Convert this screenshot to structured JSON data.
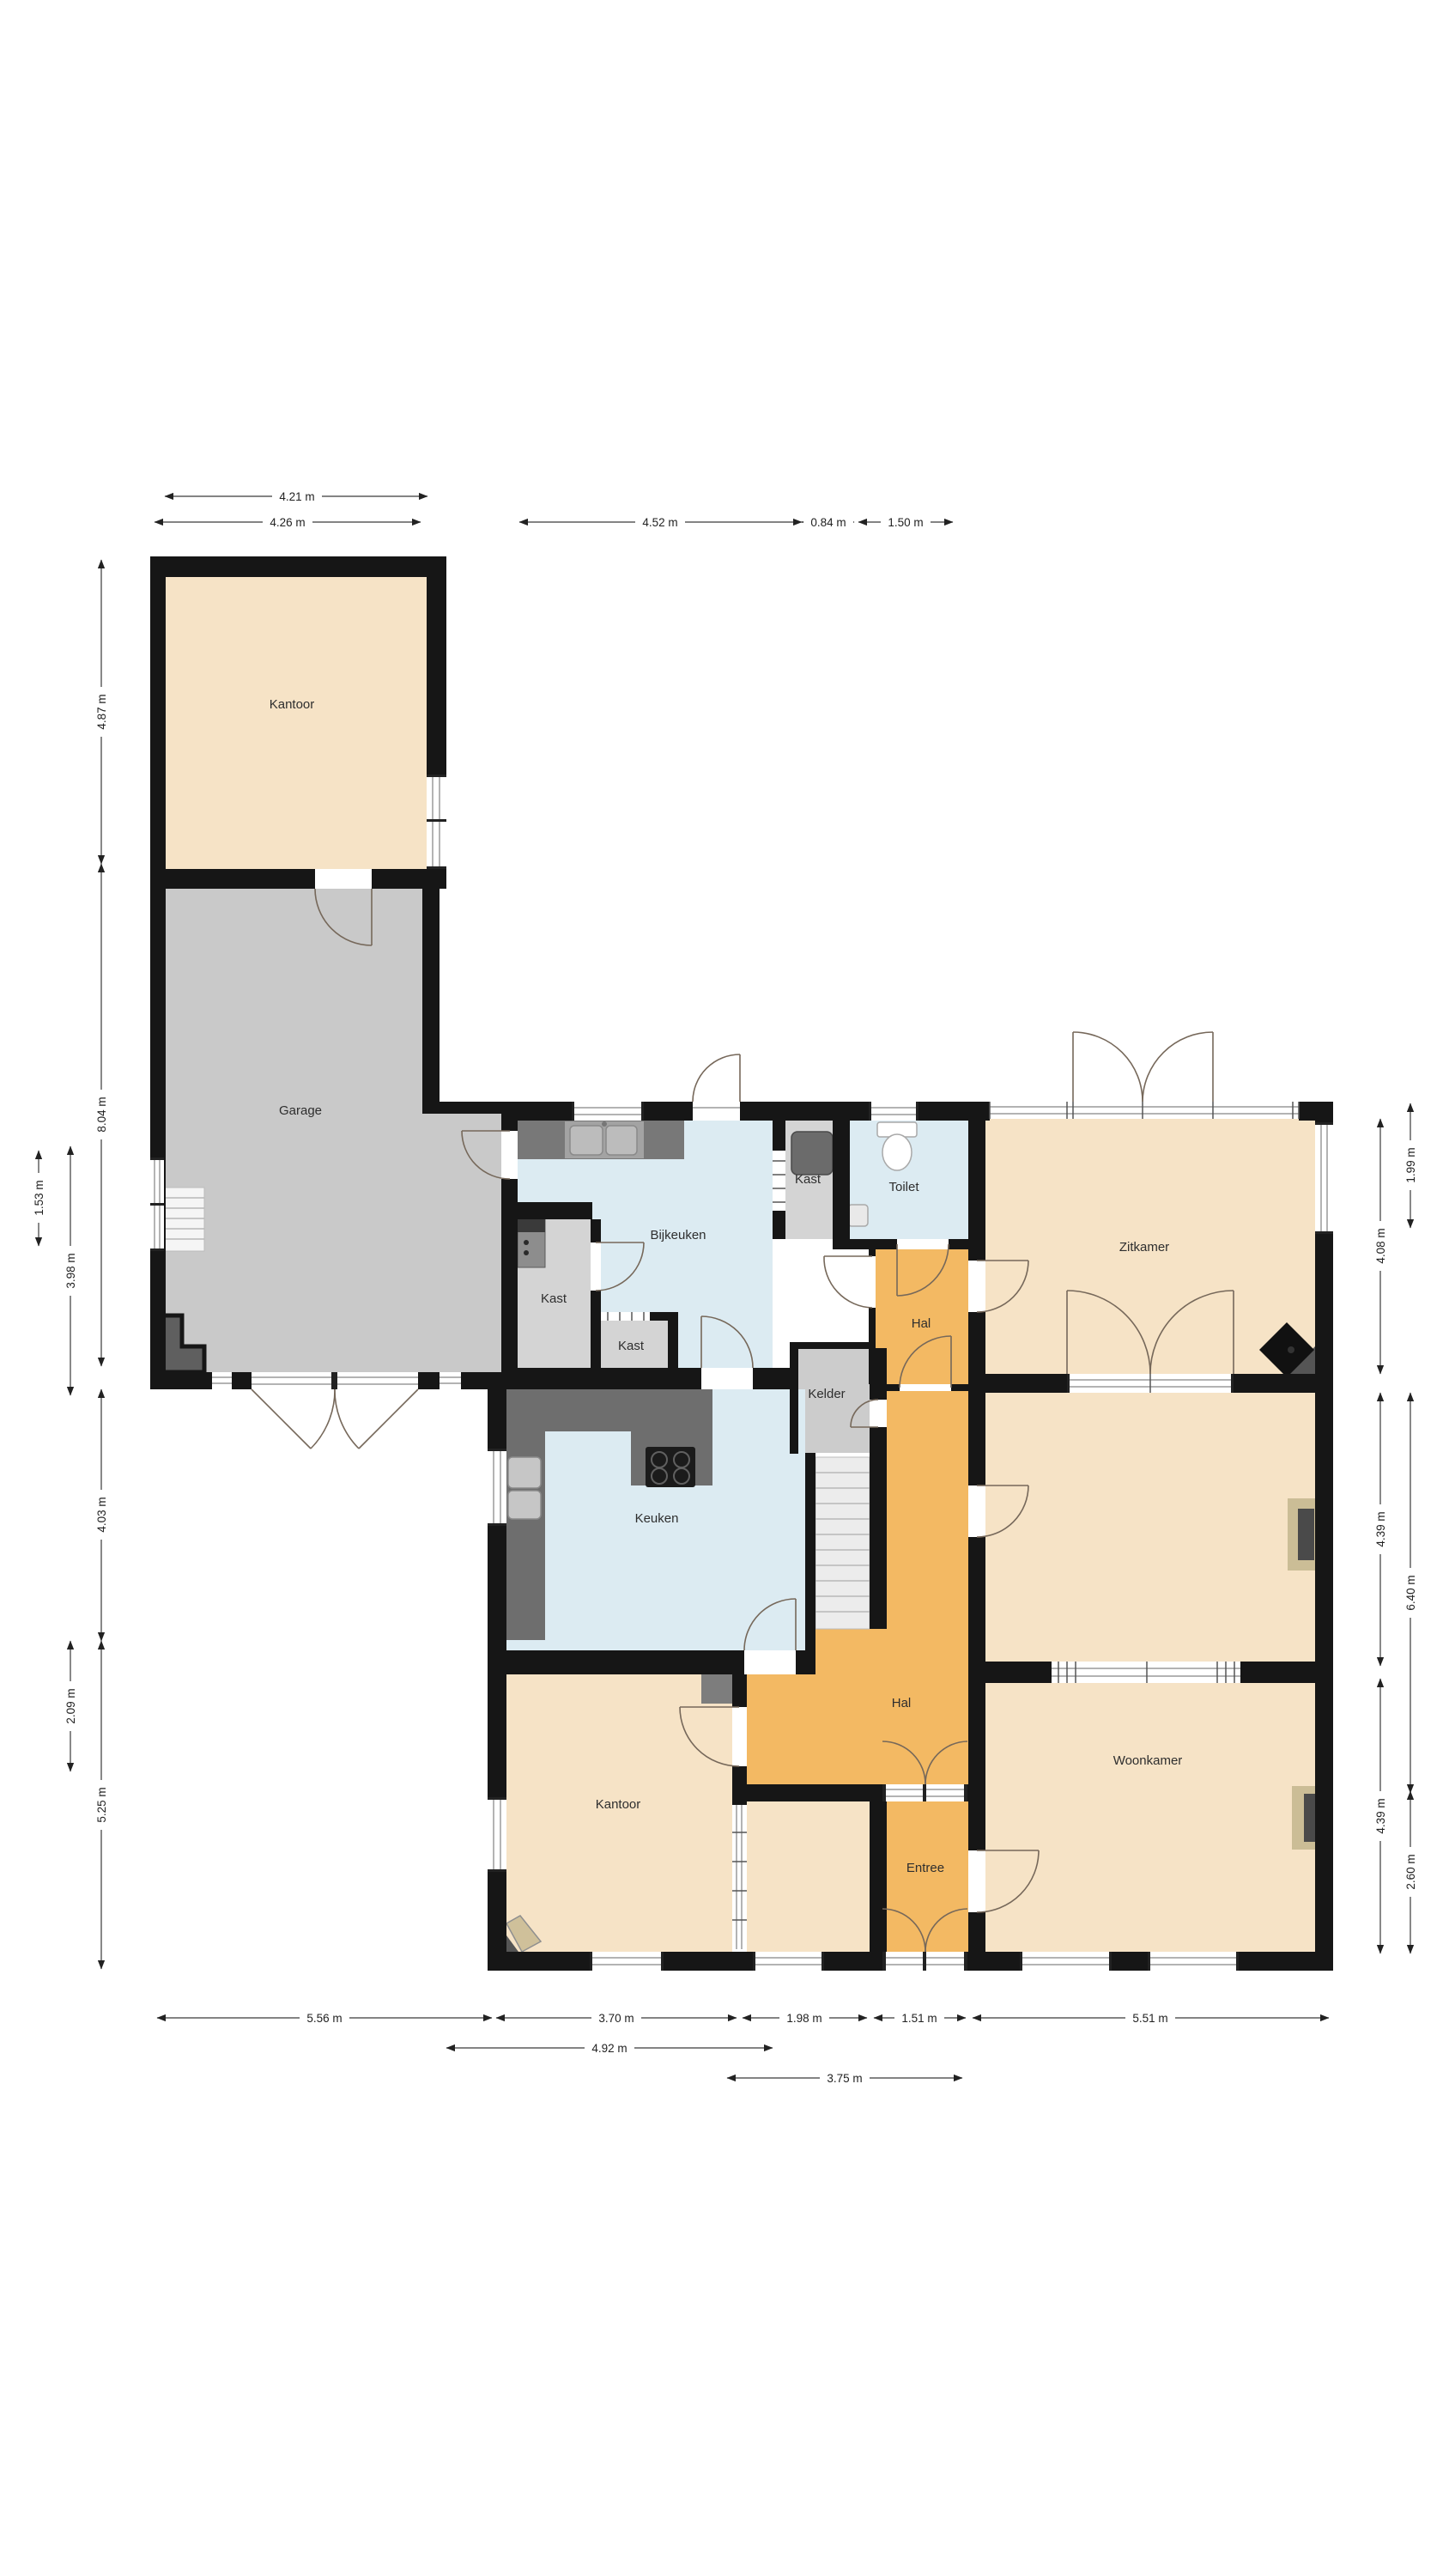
{
  "page": {
    "background": "#ffffff",
    "type": "floor-plan"
  },
  "colors": {
    "wall": "#161616",
    "room_peach": "#f6e3c6",
    "room_orange": "#f3b963",
    "room_blue": "#dcebf2",
    "room_gray": "#c9c9c9",
    "counter_dark": "#6e6e6e",
    "stairs_light": "#ececec",
    "fixture_tan": "#cbbd96",
    "fixture_dark": "#4a4a4a"
  },
  "rooms": {
    "kantoor_top": {
      "label": "Kantoor"
    },
    "garage": {
      "label": "Garage"
    },
    "bijkeuken": {
      "label": "Bijkeuken"
    },
    "kast_left": {
      "label": "Kast"
    },
    "kast_bottom": {
      "label": "Kast"
    },
    "kast_right": {
      "label": "Kast"
    },
    "toilet": {
      "label": "Toilet"
    },
    "hal_upper": {
      "label": "Hal"
    },
    "kelder": {
      "label": "Kelder"
    },
    "zitkamer": {
      "label": "Zitkamer"
    },
    "keuken": {
      "label": "Keuken"
    },
    "hal_main": {
      "label": "Hal"
    },
    "kantoor_bottom": {
      "label": "Kantoor"
    },
    "entree": {
      "label": "Entree"
    },
    "woonkamer": {
      "label": "Woonkamer"
    }
  },
  "dimensions": {
    "top": [
      {
        "label": "4.21 m"
      },
      {
        "label": "4.26 m"
      },
      {
        "label": "4.52 m"
      },
      {
        "label": "0.84 m"
      },
      {
        "label": "1.50 m"
      }
    ],
    "bottom": [
      {
        "label": "5.56 m"
      },
      {
        "label": "3.70 m"
      },
      {
        "label": "1.98 m"
      },
      {
        "label": "1.51 m"
      },
      {
        "label": "5.51 m"
      },
      {
        "label": "4.92 m"
      },
      {
        "label": "3.75 m"
      }
    ],
    "left": [
      {
        "label": "4.87 m"
      },
      {
        "label": "8.04 m"
      },
      {
        "label": "1.53 m"
      },
      {
        "label": "3.98 m"
      },
      {
        "label": "4.03 m"
      },
      {
        "label": "2.09 m"
      },
      {
        "label": "5.25 m"
      }
    ],
    "right": [
      {
        "label": "1.99 m"
      },
      {
        "label": "4.08 m"
      },
      {
        "label": "4.39 m"
      },
      {
        "label": "6.40 m"
      },
      {
        "label": "4.39 m"
      },
      {
        "label": "2.60 m"
      }
    ]
  }
}
